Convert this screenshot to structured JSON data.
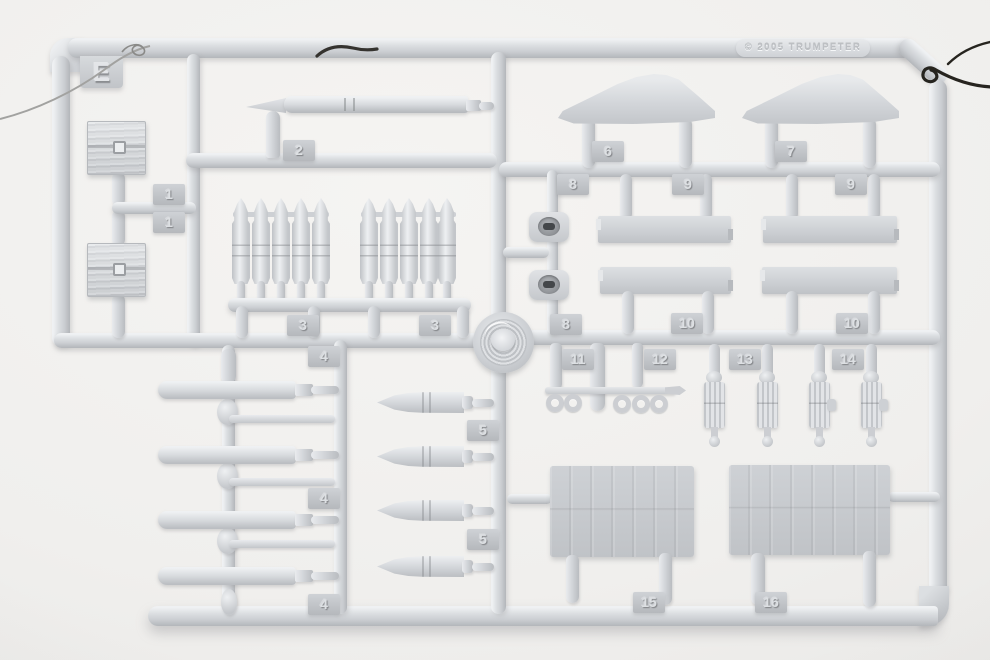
{
  "image": {
    "type": "photograph",
    "subject": "injection-molded plastic model kit parts sprue (runner) on a light studio background",
    "sprue_letter": "E",
    "copyright": "© 2005  TRUMPETER",
    "colors": {
      "plastic": "#d6d9dc",
      "plastic_highlight": "#eff1f3",
      "plastic_shadow": "#b3b6ba",
      "tag_plate": "#c2c5c9",
      "background": "#f0efed",
      "wire_dark": "#2b2b27",
      "wire_light": "#a2a2a0",
      "fitting_slot": "#44474a"
    }
  },
  "tags": [
    "1",
    "1",
    "2",
    "3",
    "3",
    "4",
    "4",
    "4",
    "5",
    "5",
    "6",
    "7",
    "8",
    "9",
    "9",
    "8",
    "10",
    "10",
    "11",
    "12",
    "13",
    "14",
    "15",
    "16"
  ],
  "visible_parts": [
    {
      "number": "1",
      "description": "wooden ammunition crate",
      "quantity": 2
    },
    {
      "number": "2",
      "description": "long tapered gun barrel",
      "quantity": 1
    },
    {
      "number": "3",
      "description": "cluster of five shell rounds",
      "quantity": 2
    },
    {
      "number": "4",
      "description": "torpedo body with tail rod",
      "quantity": 4
    },
    {
      "number": "5",
      "description": "pointed projectile shell",
      "quantity": 4
    },
    {
      "number": "6",
      "description": "curved fin panel",
      "quantity": 1
    },
    {
      "number": "7",
      "description": "curved fin panel",
      "quantity": 1
    },
    {
      "number": "8",
      "description": "round deck fitting with slotted center",
      "quantity": 2
    },
    {
      "number": "9",
      "description": "flat rectangular beam",
      "quantity": 2
    },
    {
      "number": "10",
      "description": "flat rectangular beam",
      "quantity": 2
    },
    {
      "number": "11",
      "description": "rack with hanging rings",
      "quantity": 1
    },
    {
      "number": "12",
      "description": "short thick rod",
      "quantity": 1
    },
    {
      "number": "13",
      "description": "ribbed winch davit",
      "quantity": 2
    },
    {
      "number": "14",
      "description": "ribbed winch davit with side lug",
      "quantity": 2
    },
    {
      "number": "15",
      "description": "planked deck panel",
      "quantity": 1
    },
    {
      "number": "16",
      "description": "planked deck panel",
      "quantity": 1
    }
  ],
  "unnumbered_parts": [
    "coiled rope reel at sprue center",
    "gray hanging wire at top left",
    "black wire tie at top right",
    "dark wire twist on top rail"
  ]
}
